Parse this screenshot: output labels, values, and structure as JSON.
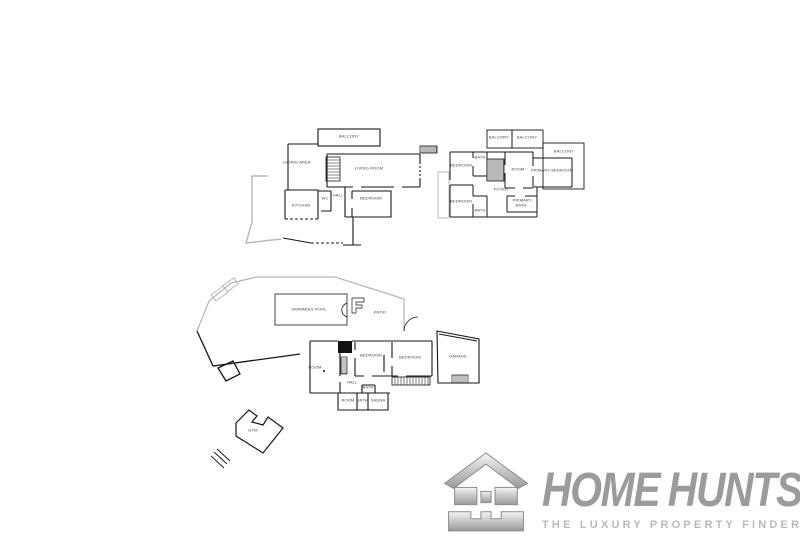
{
  "canvas": {
    "width": 800,
    "height": 541,
    "background": "#ffffff"
  },
  "plans": {
    "first_floor": {
      "name": "first-floor",
      "rooms": [
        {
          "id": "balcony",
          "label": "BALCONY",
          "x": 349,
          "y": 137
        },
        {
          "id": "dining-area",
          "label": "DINING AREA",
          "x": 297,
          "y": 163
        },
        {
          "id": "living-room",
          "label": "LIVING ROOM",
          "x": 369,
          "y": 169
        },
        {
          "id": "kitchen",
          "label": "KITCHEN",
          "x": 301,
          "y": 206
        },
        {
          "id": "wc",
          "label": "WC",
          "x": 325,
          "y": 199
        },
        {
          "id": "hall",
          "label": "HALL",
          "x": 338,
          "y": 196
        },
        {
          "id": "bedroom",
          "label": "BEDROOM",
          "x": 371,
          "y": 199
        }
      ]
    },
    "second_floor": {
      "name": "second-floor",
      "rooms": [
        {
          "id": "balcony-left",
          "label": "BALCONY",
          "x": 499,
          "y": 138
        },
        {
          "id": "balcony-middle",
          "label": "BALCONY",
          "x": 527,
          "y": 138
        },
        {
          "id": "balcony-right",
          "label": "BALCONY",
          "x": 564,
          "y": 152
        },
        {
          "id": "bedroom-upper",
          "label": "BEDROOM",
          "x": 461,
          "y": 166
        },
        {
          "id": "bath-upper",
          "label": "BATH",
          "x": 480,
          "y": 158
        },
        {
          "id": "room",
          "label": "ROOM",
          "x": 518,
          "y": 170
        },
        {
          "id": "primary-bedroom",
          "label": "PRIMARY BEDROOM",
          "x": 552,
          "y": 171
        },
        {
          "id": "foyer",
          "label": "FOYER",
          "x": 501,
          "y": 190
        },
        {
          "id": "bedroom-lower",
          "label": "BEDROOM",
          "x": 461,
          "y": 202
        },
        {
          "id": "bath-lower",
          "label": "BATH",
          "x": 480,
          "y": 211
        },
        {
          "id": "primary-bath",
          "label": "PRIMARY BATH",
          "x": 521,
          "y": 203,
          "wrap": true
        }
      ]
    },
    "ground_floor": {
      "name": "ground-floor",
      "rooms": [
        {
          "id": "swimming-pool",
          "label": "SWIMMING POOL",
          "x": 309,
          "y": 310
        },
        {
          "id": "patio",
          "label": "PATIO",
          "x": 380,
          "y": 313
        },
        {
          "id": "room-main",
          "label": "ROOM",
          "x": 315,
          "y": 368
        },
        {
          "id": "bedroom-left",
          "label": "BEDROOM",
          "x": 371,
          "y": 356
        },
        {
          "id": "bedroom-right",
          "label": "BEDROOM",
          "x": 410,
          "y": 358
        },
        {
          "id": "hall",
          "label": "HALL",
          "x": 352,
          "y": 383
        },
        {
          "id": "room-small",
          "label": "ROOM",
          "x": 348,
          "y": 401
        },
        {
          "id": "bath-small",
          "label": "BATH",
          "x": 362,
          "y": 401
        },
        {
          "id": "bath-inner",
          "label": "BATH",
          "x": 368,
          "y": 388
        },
        {
          "id": "sauna",
          "label": "SAUNA",
          "x": 378,
          "y": 401
        },
        {
          "id": "garage",
          "label": "GARAGE",
          "x": 458,
          "y": 357
        },
        {
          "id": "gym",
          "label": "GYM",
          "x": 253,
          "y": 431
        }
      ]
    }
  },
  "logo": {
    "brand_word_1": "HOME",
    "brand_word_2": "HUNTS",
    "tagline": "THE LUXURY PROPERTY FINDERS",
    "colors": {
      "brand_gray": "#9b9b9b",
      "tagline_gray": "#b9b9b9",
      "icon_silver_light": "#f5f5f5",
      "icon_silver_dark": "#9a9a9a"
    }
  }
}
